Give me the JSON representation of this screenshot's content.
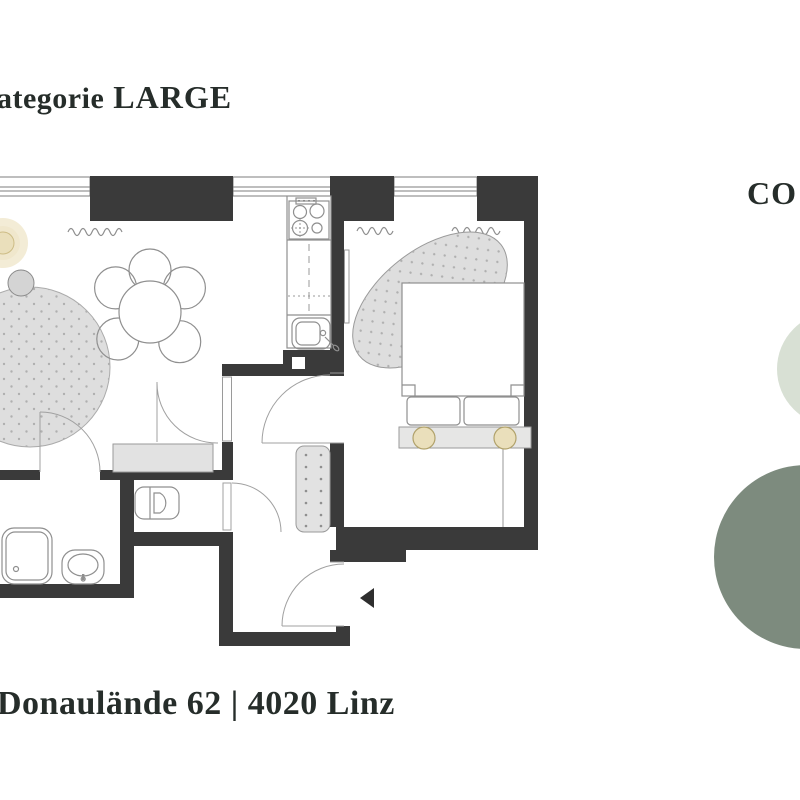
{
  "title": {
    "prefix": "ategorie",
    "emphasis": "LARGE"
  },
  "address": "Donaulände 62 | 4020 Linz",
  "side_label": "CO",
  "colors": {
    "text": "#262d2a",
    "wall": "#3a3a3a",
    "outline_gray": "#8f8f8f",
    "furniture_light_gray": "#e2e2e2",
    "rug_gray": "#dedede",
    "lamp_beige": "#eadfbb",
    "lamp_ring": "#b1a26b",
    "glow_cream": "#f3ecd6",
    "circle_light_sage": "#d8e0d4",
    "circle_dark_sage": "#7d8b7e",
    "entrance_arrow": "#2e2e2e"
  },
  "floorplan": {
    "rooms": [
      "living-dining",
      "kitchen",
      "bedroom",
      "bathroom",
      "wc",
      "hall"
    ],
    "furniture": [
      "round-rug",
      "side-table",
      "floor-lamp",
      "dining-table",
      "chairs",
      "stove",
      "kitchen-sink",
      "bed",
      "pillows",
      "headboard-lamps",
      "bedroom-rug",
      "shower",
      "bath-sink",
      "toilet",
      "sideboard",
      "runner-rug"
    ]
  }
}
